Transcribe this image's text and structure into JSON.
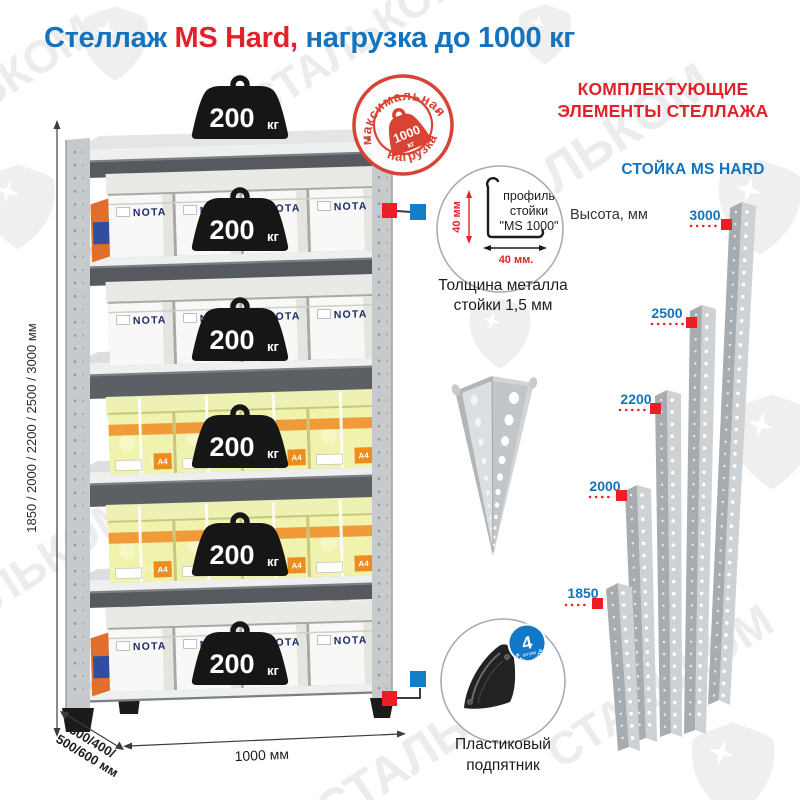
{
  "title": {
    "part1": "Стеллаж ",
    "part2": "MS Hard,",
    "part3": " нагрузка до 1000 кг"
  },
  "watermark": {
    "brand": "СТАЛЬКОМ"
  },
  "stamp": {
    "arc_top": "максимальная",
    "arc_bottom": "нагрузка",
    "value": "1000",
    "unit": "кг"
  },
  "rack": {
    "weight_value": "200",
    "weight_unit": "кг",
    "white_box_brand": "NOTA",
    "paper_format": "A4",
    "dims": {
      "height_options": "1850 / 2000 / 2200 / 2500 / 3000 мм",
      "depth_line1": "300/400/",
      "depth_line2": "500/600 мм",
      "width": "1000 мм"
    }
  },
  "profile_detail": {
    "label_line1": "профиль",
    "label_line2": "стойки",
    "label_line3": "\"MS 1000\"",
    "dim_vertical": "40 мм",
    "dim_horizontal": "40 мм.",
    "caption_line1": "Толщина металла",
    "caption_line2": "стойки 1,5 мм"
  },
  "foot_detail": {
    "badge_value": "4",
    "badge_unit": "штуки",
    "badge_arc": "в комплекте",
    "caption_line1": "Пластиковый",
    "caption_line2": "подпятник"
  },
  "components": {
    "heading_line1": "КОМПЛЕКТУЮЩИЕ",
    "heading_line2": "ЭЛЕМЕНТЫ СТЕЛЛАЖА",
    "subheading": "СТОЙКА MS HARD",
    "height_label": "Высота, мм",
    "posts": [
      {
        "label": "3000"
      },
      {
        "label": "2500"
      },
      {
        "label": "2200"
      },
      {
        "label": "2000"
      },
      {
        "label": "1850"
      }
    ]
  },
  "colors": {
    "blue": "#1573bd",
    "red": "#e2222a",
    "stamp_red": "#d84334",
    "marker_red": "#ee1c25",
    "marker_blue": "#147dc8",
    "weight_black": "#161616",
    "post_gray": "#c6cacd",
    "yellow_box": "#eff3ad",
    "orange": "#f09a3a",
    "watermark_gray": "#ececec"
  }
}
